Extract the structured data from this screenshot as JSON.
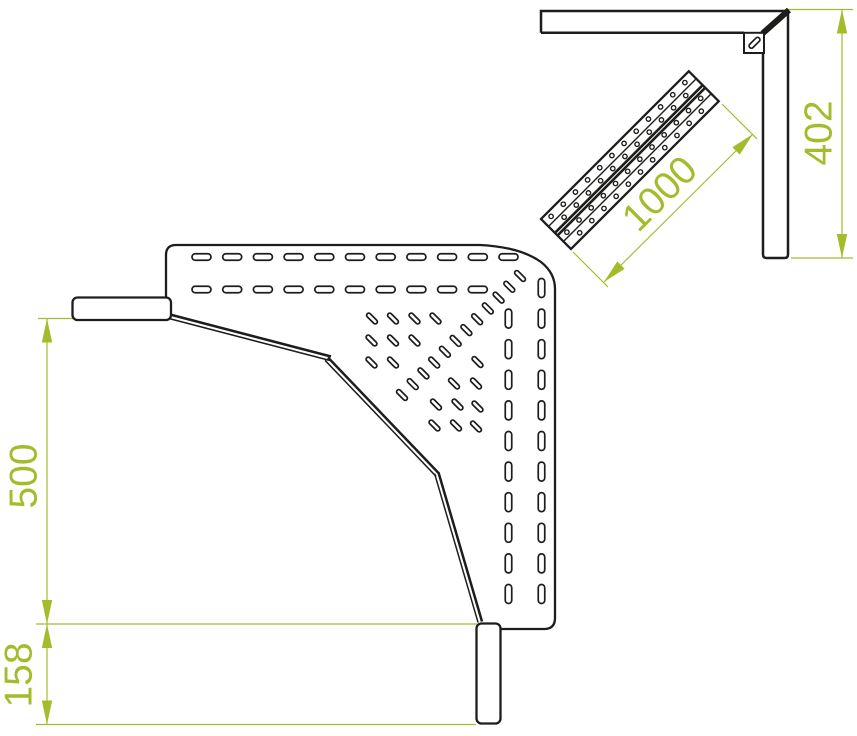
{
  "drawing": {
    "title": "cable-tray-corner-technical-drawing",
    "colors": {
      "background": "#ffffff",
      "line": "#1d1d1b",
      "accent": "#a4bc2c"
    },
    "labels": {
      "dim_left_upper": "500",
      "dim_left_lower": "158",
      "dim_diagonal": "1000",
      "dim_right": "402"
    },
    "plate": {
      "h_slot": {
        "w": 19,
        "h": 6.5,
        "rx": 3.2
      },
      "h_rows": [
        {
          "y": 257,
          "x0": 192,
          "pitch": 30.7,
          "n": 11
        },
        {
          "y": 289.5,
          "x0": 192,
          "pitch": 30.7,
          "n": 10
        }
      ],
      "v_slot": {
        "w": 6.5,
        "h": 19,
        "rx": 3.2
      },
      "v_cols": [
        {
          "x": 541.5,
          "y0": 288,
          "pitch": 30.6,
          "n": 11
        },
        {
          "x": 508.5,
          "y0": 318.6,
          "pitch": 30.6,
          "n": 10
        }
      ],
      "d_slot": {
        "len": 13.5,
        "wid": 4.3,
        "angle": 45
      },
      "d_grid": [
        [
          372,
          318.5
        ],
        [
          393,
          318.5
        ],
        [
          414.5,
          318.5
        ],
        [
          435.5,
          318.5
        ],
        [
          371.5,
          340.5
        ],
        [
          393,
          340.5
        ],
        [
          414.5,
          340.5
        ],
        [
          371.5,
          362.5
        ],
        [
          393,
          362.5
        ],
        [
          477.5,
          362
        ],
        [
          454,
          383.5
        ],
        [
          476,
          383.5
        ],
        [
          436,
          404.5
        ],
        [
          457.5,
          404.5
        ],
        [
          477.5,
          406.5
        ],
        [
          434.5,
          425.5
        ],
        [
          456,
          425.5
        ],
        [
          476,
          426.5
        ]
      ],
      "d_chain": {
        "x0": 402,
        "y0": 395,
        "dx": 10.73,
        "dy": -10.82,
        "n": 12
      }
    },
    "rail": {
      "pitch": 17.2,
      "hole_r": 2.2,
      "hole_rows": [
        {
          "w": 5.3,
          "s0": 9,
          "n": 12
        },
        {
          "w": 15.1,
          "s0": 17.6,
          "n": 11
        },
        {
          "w": 27.6,
          "s0": 9,
          "n": 12
        },
        {
          "w": 37.1,
          "s0": 17.6,
          "n": 11
        }
      ]
    },
    "arrow": {
      "len": 24,
      "half_w": 5.2
    },
    "arrows": [
      {
        "x": 47,
        "y": 318.5,
        "a": -90
      },
      {
        "x": 47,
        "y": 624,
        "a": 90
      },
      {
        "x": 47,
        "y": 624,
        "a": -90
      },
      {
        "x": 47,
        "y": 724.5,
        "a": 90
      },
      {
        "x": 842,
        "y": 9.5,
        "a": -90
      },
      {
        "x": 842,
        "y": 258,
        "a": 90
      },
      {
        "x": 604,
        "y": 282,
        "a": 135
      },
      {
        "x": 753,
        "y": 134,
        "a": -45
      }
    ]
  }
}
